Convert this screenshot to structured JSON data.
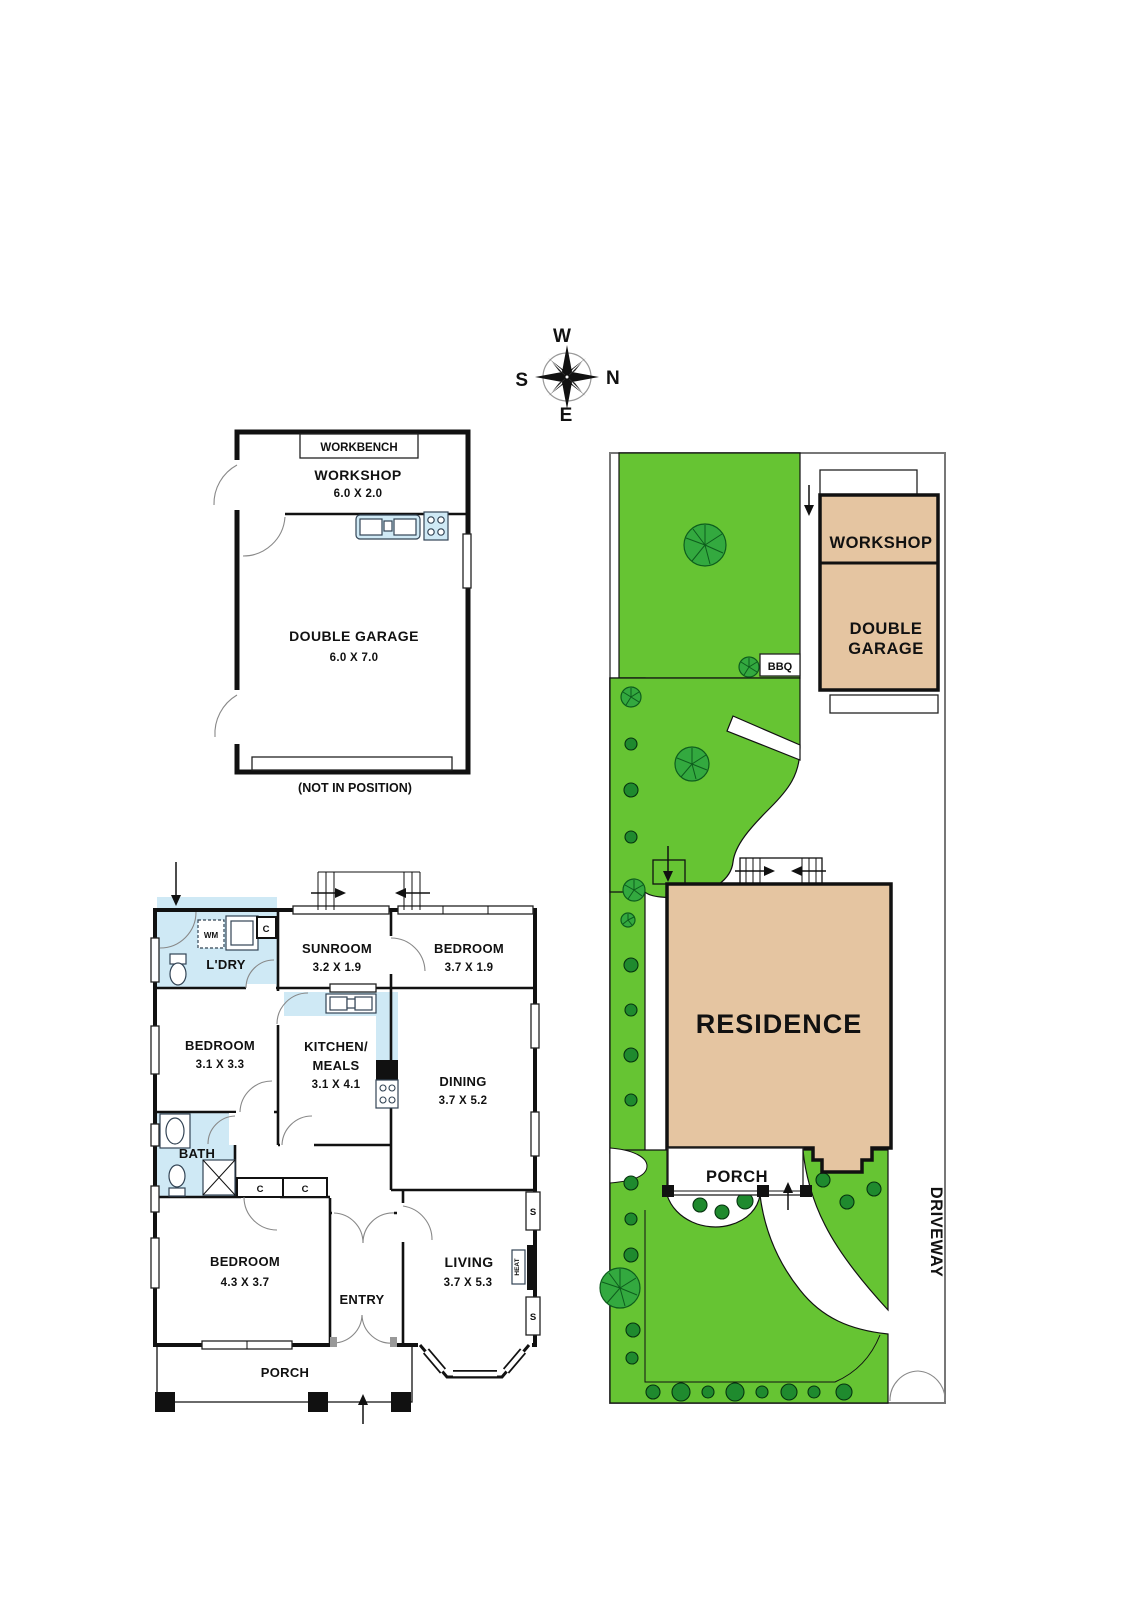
{
  "compass": {
    "west": "W",
    "north": "N",
    "south": "S",
    "east": "E"
  },
  "outbuilding": {
    "workbench": "WORKBENCH",
    "workshop_name": "WORKSHOP",
    "workshop_dims": "6.0 X 2.0",
    "garage_name": "DOUBLE GARAGE",
    "garage_dims": "6.0 X 7.0",
    "note": "(NOT IN POSITION)"
  },
  "house": {
    "laundry": "L'DRY",
    "wm": "WM",
    "closet1": "C",
    "sunroom_name": "SUNROOM",
    "sunroom_dims": "3.2 X 1.9",
    "bedroom1_name": "BEDROOM",
    "bedroom1_dims": "3.7 X 1.9",
    "bedroom2_name": "BEDROOM",
    "bedroom2_dims": "3.1 X 3.3",
    "kitchen_line1": "KITCHEN/",
    "kitchen_line2": "MEALS",
    "kitchen_dims": "3.1 X 4.1",
    "dining_name": "DINING",
    "dining_dims": "3.7 X 5.2",
    "bath": "BATH",
    "closet2": "C",
    "closet3": "C",
    "bedroom3_name": "BEDROOM",
    "bedroom3_dims": "4.3 X 3.7",
    "entry": "ENTRY",
    "living_name": "LIVING",
    "living_dims": "3.7 X 5.3",
    "heat": "HEAT",
    "window_s_top": "S",
    "window_s_bottom": "S",
    "porch": "PORCH"
  },
  "site": {
    "workshop": "WORKSHOP",
    "garage_line1": "DOUBLE",
    "garage_line2": "GARAGE",
    "bbq": "BBQ",
    "residence": "RESIDENCE",
    "porch": "PORCH",
    "driveway": "DRIVEWAY"
  },
  "colors": {
    "lawn": "#66C433",
    "tree": "#33A93F",
    "shrub": "#1F8A2E",
    "building": "#E5C5A1",
    "wet_area": "#CFE9F5"
  }
}
